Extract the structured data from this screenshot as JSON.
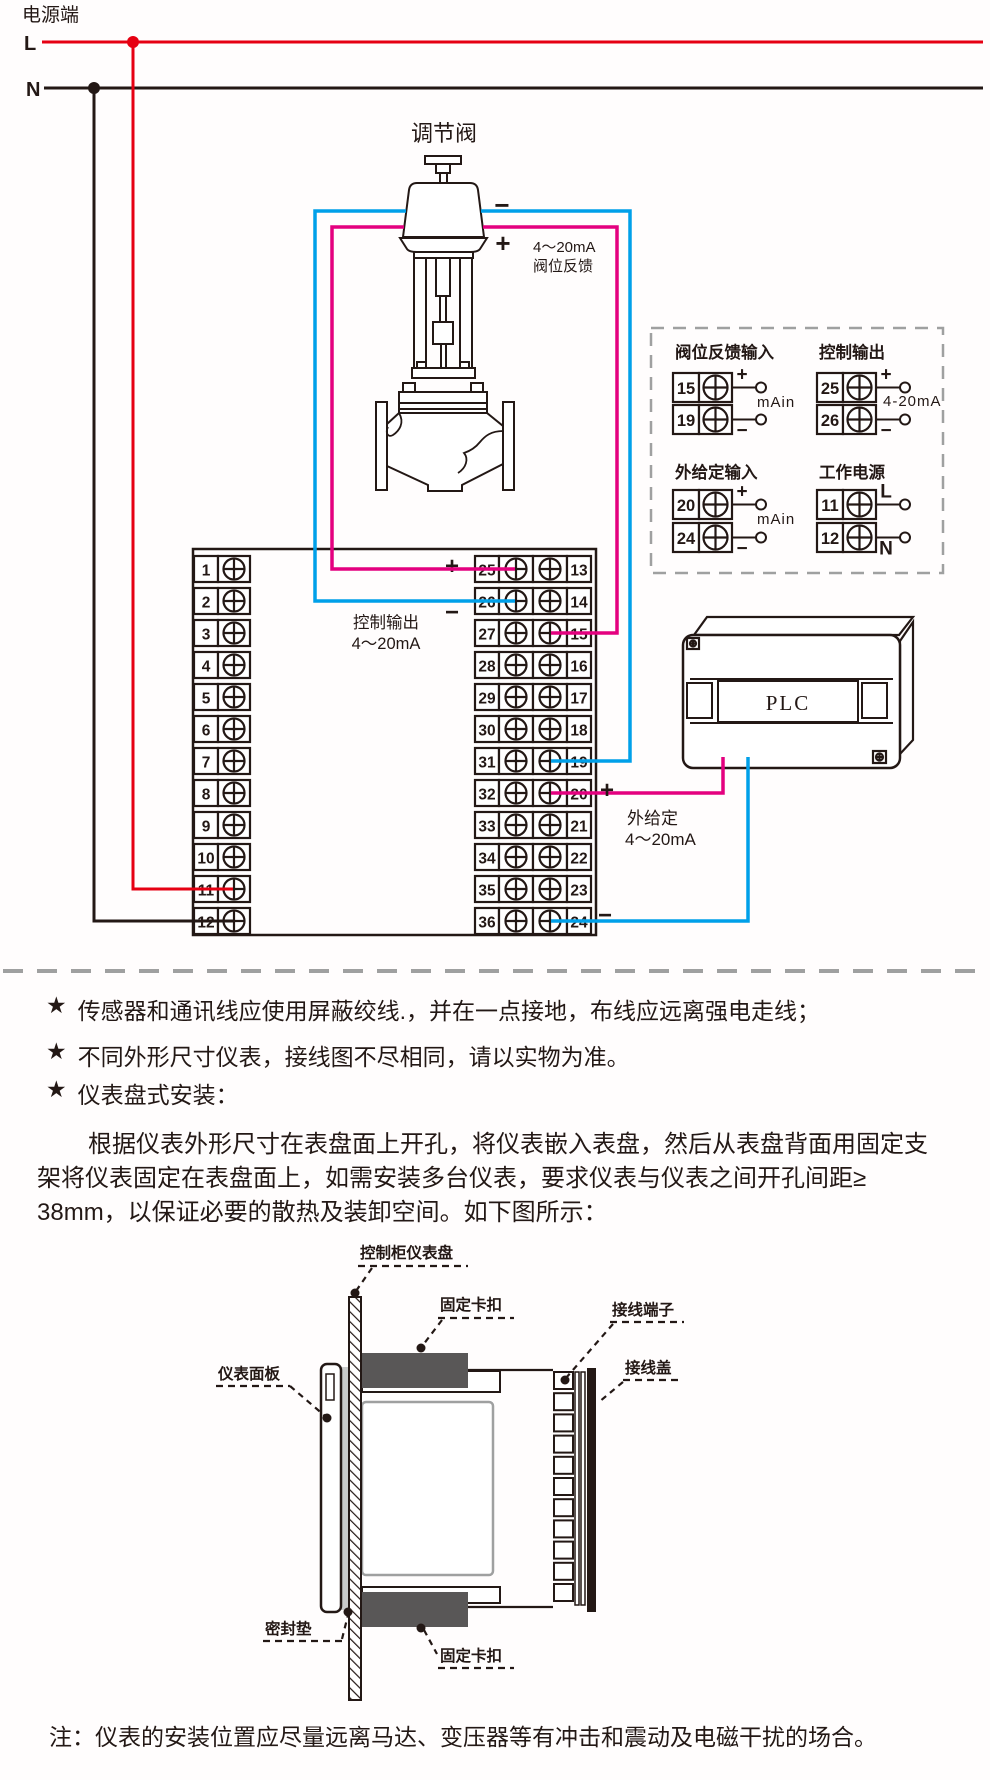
{
  "colors": {
    "red": "#e60012",
    "blue": "#00a0e9",
    "magenta": "#e4007f",
    "line": "#231815",
    "gray_dash": "#9fa0a0",
    "clip_dark": "#595757",
    "gasket_gray": "#c9caca"
  },
  "power": {
    "title": "电源端",
    "l_label": "L",
    "n_label": "N"
  },
  "valve": {
    "title": "调节阀",
    "minus": "−",
    "plus": "+",
    "feedback_label_1": "4～20mA",
    "feedback_label_2": "阀位反馈"
  },
  "main_block": {
    "left_numbers": [
      "1",
      "2",
      "3",
      "4",
      "5",
      "6",
      "7",
      "8",
      "9",
      "10",
      "11",
      "12"
    ],
    "mid_numbers": [
      "25",
      "26",
      "27",
      "28",
      "29",
      "30",
      "31",
      "32",
      "33",
      "34",
      "35",
      "36"
    ],
    "right_numbers": [
      "13",
      "14",
      "15",
      "16",
      "17",
      "18",
      "19",
      "20",
      "21",
      "22",
      "23",
      "24"
    ],
    "control_output_label": "控制输出",
    "control_output_range": "4～20mA",
    "plus": "+",
    "minus": "−"
  },
  "setpoint_wiring": {
    "plus": "+",
    "minus": "−",
    "label_1": "外给定",
    "label_2": "4～20mA"
  },
  "plc_label": "PLC",
  "io_panel": {
    "groups": [
      {
        "title": "阀位反馈输入",
        "rows": [
          {
            "no": "15",
            "sign": "+"
          },
          {
            "no": "19",
            "sign": "−"
          }
        ],
        "mid_label": "mAin"
      },
      {
        "title": "控制输出",
        "rows": [
          {
            "no": "25",
            "sign": "+"
          },
          {
            "no": "26",
            "sign": "−"
          }
        ],
        "mid_label": "4-20mA"
      },
      {
        "title": "外给定输入",
        "rows": [
          {
            "no": "20",
            "sign": "+"
          },
          {
            "no": "24",
            "sign": "−"
          }
        ],
        "mid_label": "mAin"
      },
      {
        "title": "工作电源",
        "rows": [
          {
            "no": "11",
            "sign": "L"
          },
          {
            "no": "12",
            "sign": "N"
          }
        ],
        "mid_label": ""
      }
    ]
  },
  "notes": {
    "bullet_star": "★",
    "bullets": [
      "传感器和通讯线应使用屏蔽绞线.，并在一点接地，布线应远离强电走线；",
      "不同外形尺寸仪表，接线图不尽相同，请以实物为准。",
      "仪表盘式安装："
    ],
    "paragraph_lines": [
      "根据仪表外形尺寸在表盘面上开孔，将仪表嵌入表盘，然后从表盘背面用固定支",
      "架将仪表固定在表盘面上，如需安装多台仪表，要求仪表与仪表之间开孔间距≥",
      "38mm，以保证必要的散热及装卸空间。如下图所示："
    ],
    "footnote": "注：仪表的安装位置应尽量远离马达、变压器等有冲击和震动及电磁干扰的场合。"
  },
  "mounting": {
    "labels": {
      "cabinet_panel": "控制柜仪表盘",
      "top_clip": "固定卡扣",
      "front_panel": "仪表面板",
      "terminal_block": "接线端子",
      "wiring_cover": "接线盖",
      "gasket": "密封垫",
      "bottom_clip": "固定卡扣"
    }
  }
}
